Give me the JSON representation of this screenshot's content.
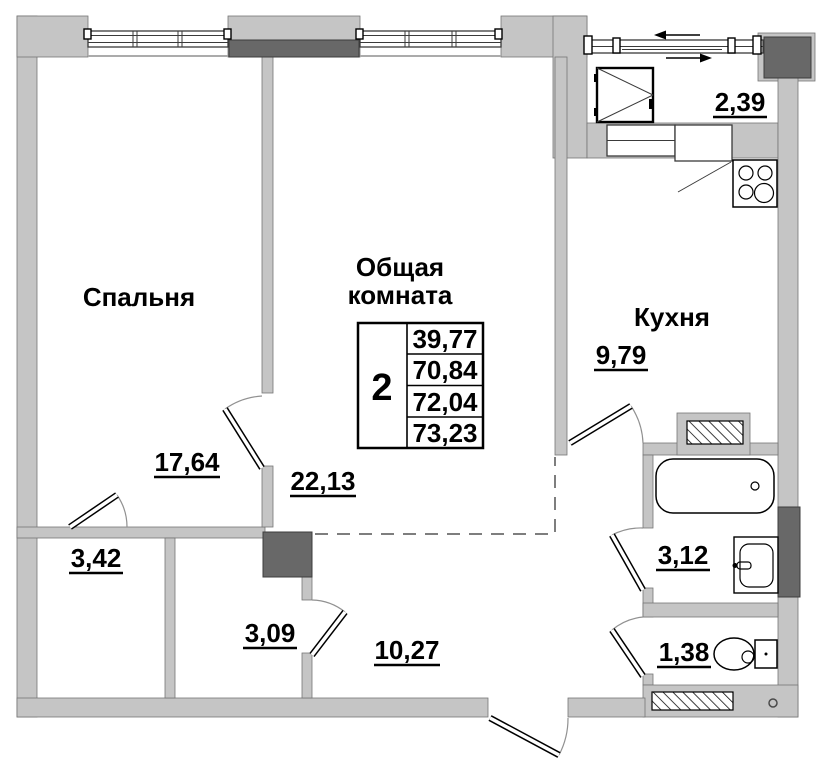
{
  "plan": {
    "rooms": {
      "bedroom": {
        "label": "Спальня",
        "area": "17,64"
      },
      "living_room": {
        "label_line1": "Общая",
        "label_line2": "комната",
        "area": "22,13"
      },
      "kitchen": {
        "label": "Кухня",
        "area": "9,79"
      },
      "storage_left": {
        "area": "3,42"
      },
      "storage_center": {
        "area": "3,09"
      },
      "hallway": {
        "area": "10,27"
      },
      "bathroom": {
        "area": "3,12"
      },
      "wc": {
        "area": "1,38"
      },
      "balcony": {
        "area": "2,39"
      }
    },
    "info_table": {
      "room_count": "2",
      "areas": [
        "39,77",
        "70,84",
        "72,04",
        "73,23"
      ]
    },
    "colors": {
      "wall_fill": "#c5c5c5",
      "shaft_fill": "#686868",
      "background": "#ffffff",
      "line": "#000000"
    }
  }
}
